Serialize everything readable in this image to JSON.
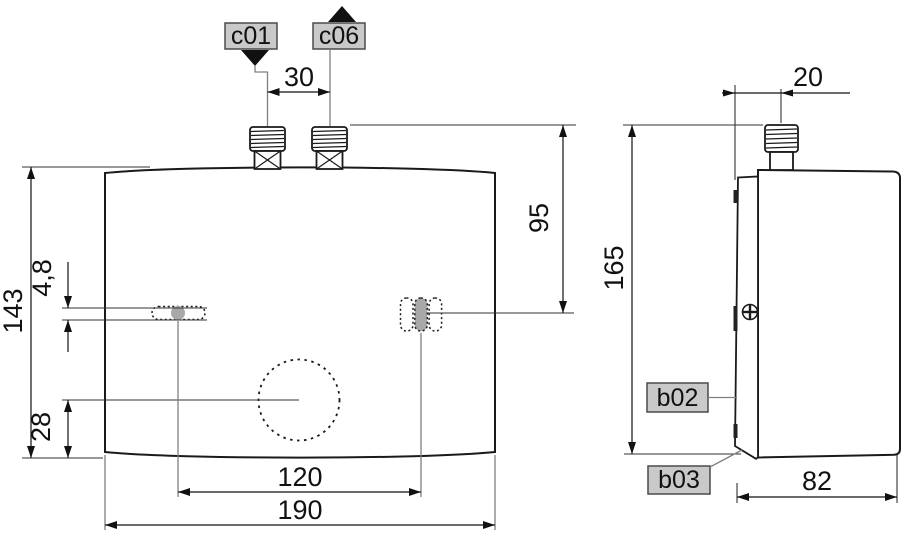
{
  "front_view": {
    "connection_labels": {
      "c01": "c01",
      "c06": "c06"
    },
    "dims": {
      "pipe_spacing": "30",
      "body_height": "143",
      "slot_height": "4,8",
      "circle_to_bottom": "28",
      "pipe_to_slot": "95",
      "mount_spacing": "120",
      "body_width": "190"
    }
  },
  "side_view": {
    "part_labels": {
      "b02": "b02",
      "b03": "b03"
    },
    "dims": {
      "pipe_offset": "20",
      "total_height": "165",
      "depth": "82"
    }
  }
}
